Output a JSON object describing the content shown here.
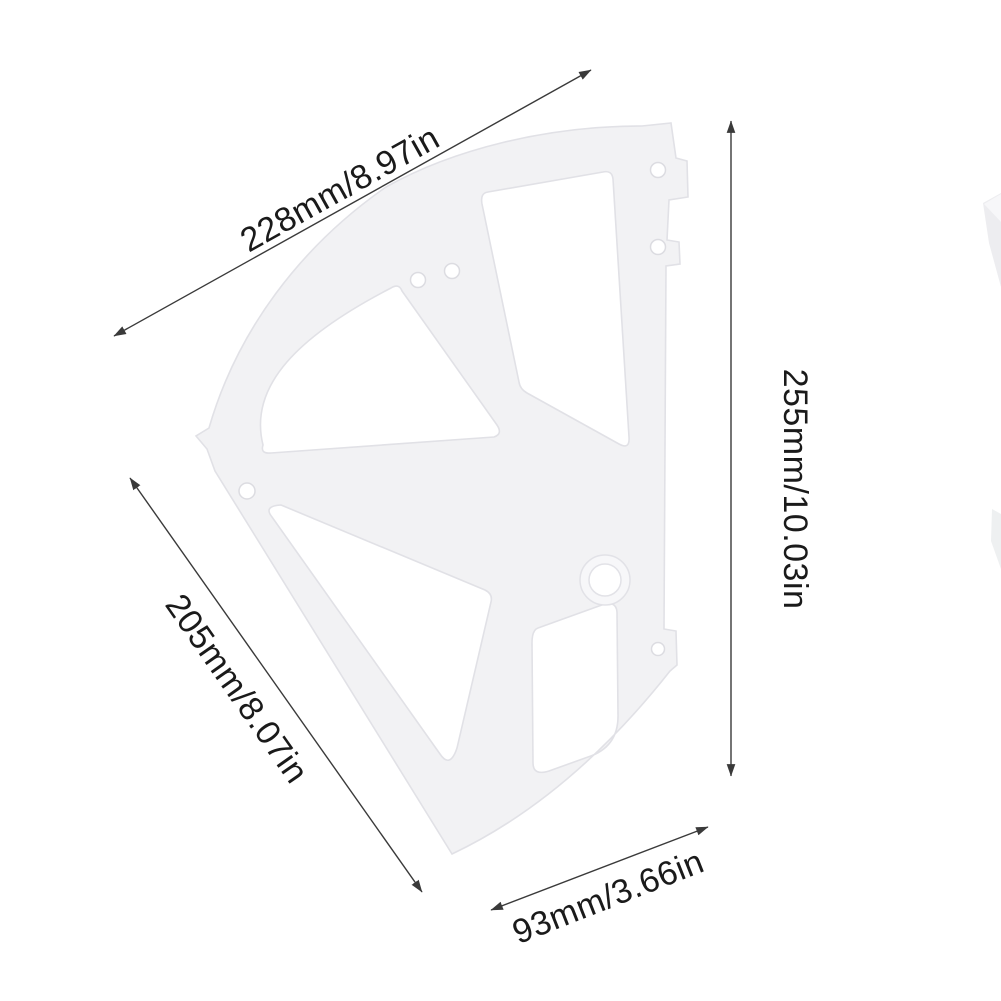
{
  "diagram": {
    "dimensions": {
      "top": {
        "label": "228mm/8.97in",
        "mm": 228,
        "in": 8.97
      },
      "right": {
        "label": "255mm/10.03in",
        "mm": 255,
        "in": 10.03
      },
      "left": {
        "label": "205mm/8.07in",
        "mm": 205,
        "in": 8.07
      },
      "bottom": {
        "label": "93mm/3.66in",
        "mm": 93,
        "in": 3.66
      }
    },
    "colors": {
      "background": "#ffffff",
      "dimension_line": "#3a3a3a",
      "label_text": "#1a1a1a",
      "part_fill": "#f2f2f4",
      "part_edge": "#e1e1e6"
    }
  }
}
